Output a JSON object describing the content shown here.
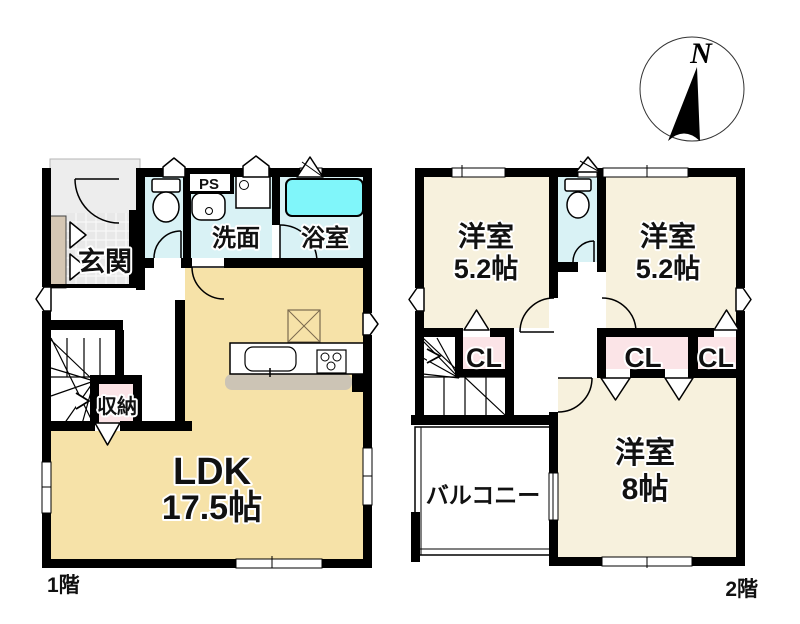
{
  "compass": {
    "north_label": "N"
  },
  "floor1": {
    "floor_label": "1階",
    "rooms": {
      "genkan": "玄関",
      "washroom": "洗面",
      "bathroom": "浴室",
      "pipe_space": "PS",
      "storage": "収納",
      "ldk_name": "LDK",
      "ldk_size": "17.5帖"
    }
  },
  "floor2": {
    "floor_label": "2階",
    "rooms": {
      "west_room_name": "洋室",
      "west_room_size": "5.2帖",
      "east_room_name": "洋室",
      "east_room_size": "5.2帖",
      "south_room_name": "洋室",
      "south_room_size": "8帖",
      "closet": "CL",
      "balcony": "バルコニー"
    }
  },
  "colors": {
    "wall": "#000000",
    "wet_room_cyan": "#d9f2f5",
    "bathtub_cyan": "#80f6fa",
    "ldk_tan": "#f6e2a8",
    "bedroom_cream": "#f7f1dd",
    "closet_pink": "#fbe4e7",
    "porch_gray": "#ededed",
    "tile_gray": "#e8e8e8",
    "shoe_cabinet_tan": "#d5c7b4",
    "counter_shadow_gray": "#ccc4b5"
  }
}
